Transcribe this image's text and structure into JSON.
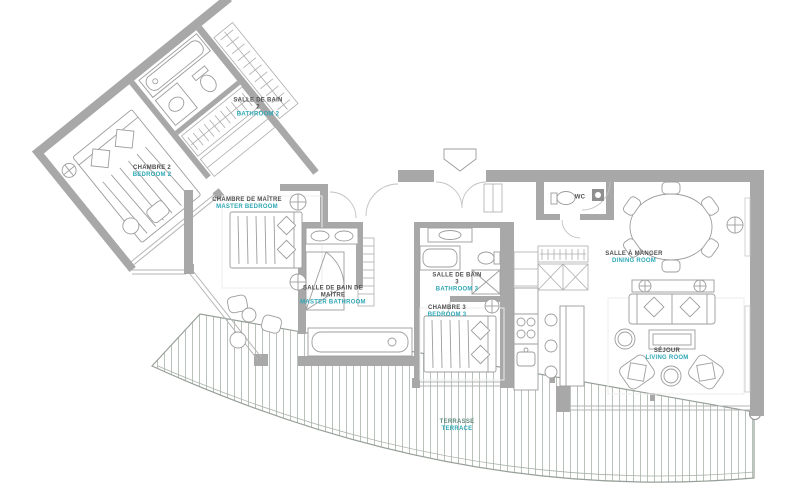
{
  "plan": {
    "title": "apartment-floor-plan",
    "colors": {
      "wall": "#a8a8a8",
      "furniture_line": "#9d9d9d",
      "door_arc": "#c2c2c2",
      "label_fr": "#4f4f4f",
      "label_en": "#2ea8b5",
      "terrace_plank": "#b9c2ba",
      "terrace_edge": "#96a098"
    },
    "rooms": {
      "bathroom2": {
        "fr": "SALLE DE BAIN 2",
        "en": "BATHROOM 2"
      },
      "bedroom2": {
        "fr": "CHAMBRE 2",
        "en": "BEDROOM 2"
      },
      "master_bedroom": {
        "fr": "CHAMBRE DE MAÎTRE",
        "en": "MASTER BEDROOM"
      },
      "master_bathroom": {
        "fr": "SALLE DE BAIN DE MAÎTRE",
        "en": "MASTER BATHROOM"
      },
      "bathroom3": {
        "fr": "SALLE DE BAIN 3",
        "en": "BATHROOM 3"
      },
      "bedroom3": {
        "fr": "CHAMBRE 3",
        "en": "BEDROOM 3"
      },
      "wc": {
        "fr": "WC",
        "en": ""
      },
      "dining": {
        "fr": "SALLE À MANGER",
        "en": "DINING ROOM"
      },
      "living": {
        "fr": "SÉJOUR",
        "en": "LIVING ROOM"
      },
      "terrace": {
        "fr": "TERRASSE",
        "en": "TERRACE"
      }
    }
  }
}
